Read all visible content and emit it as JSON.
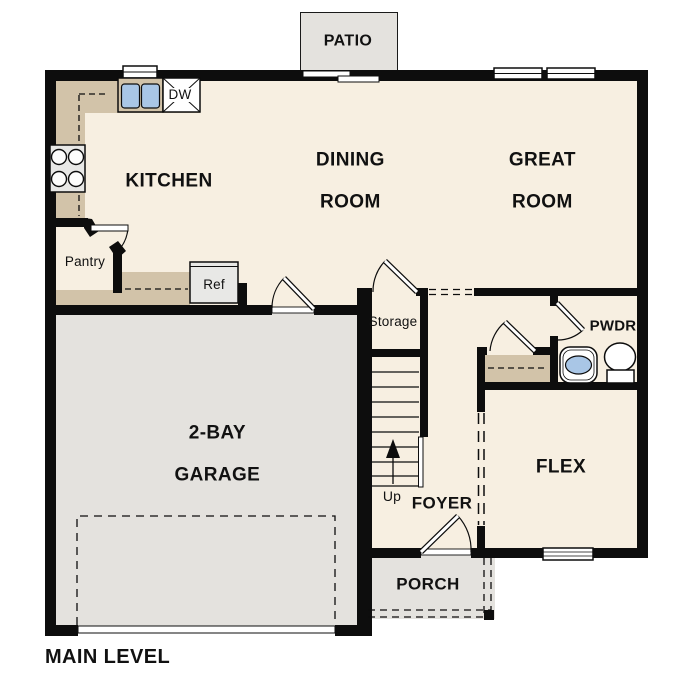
{
  "plan_title": "MAIN LEVEL",
  "rooms": {
    "patio": "PATIO",
    "kitchen": "KITCHEN",
    "dining_line1": "DINING",
    "dining_line2": "ROOM",
    "great_line1": "GREAT",
    "great_line2": "ROOM",
    "garage_line1": "2-BAY",
    "garage_line2": "GARAGE",
    "flex": "FLEX",
    "foyer": "FOYER",
    "porch": "PORCH",
    "pwdr": "PWDR",
    "storage": "Storage",
    "pantry": "Pantry"
  },
  "fixtures": {
    "refrigerator": "Ref",
    "dishwasher": "DW",
    "stairs_direction": "Up"
  },
  "colors": {
    "floor": "#f7efe1",
    "garage": "#e4e2de",
    "tan": "#d2c3a9",
    "wall": "#0d0d0d",
    "blue": "#a9c6e6",
    "appliance": "#e8e8e6",
    "outline": "#1a1a1a"
  }
}
